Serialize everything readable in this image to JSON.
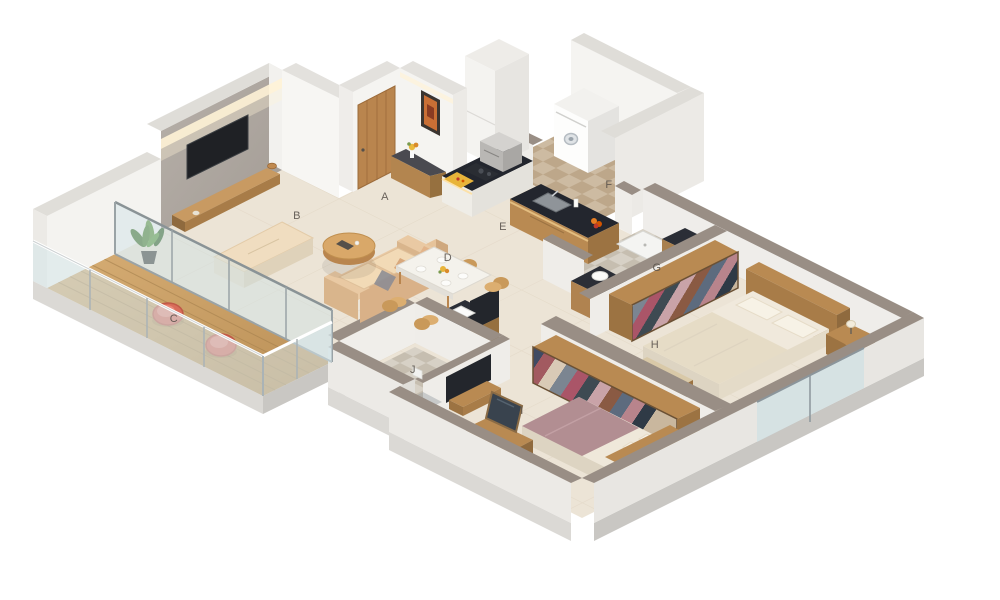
{
  "scene": {
    "kind": "isometric-3d-floor-plan-render",
    "background": "#ffffff"
  },
  "labels": [
    {
      "label": "A",
      "area": "entrance-foyer"
    },
    {
      "label": "B",
      "area": "living-room"
    },
    {
      "label": "C",
      "area": "balcony-deck"
    },
    {
      "label": "D",
      "area": "dining-area"
    },
    {
      "label": "E",
      "area": "kitchen"
    },
    {
      "label": "F",
      "area": "utility-area"
    },
    {
      "label": "G",
      "area": "bathroom"
    },
    {
      "label": "H",
      "area": "master-bedroom"
    },
    {
      "label": "I",
      "area": "bedroom-2"
    },
    {
      "label": "J",
      "area": "toilet"
    }
  ],
  "palette": {
    "wall_white": "#f5f4f1",
    "wall_cap": "#dfddd8",
    "parapet_cap": "#998e85",
    "floor_cream": "#ece4d6",
    "deck_wood": "#c9a068",
    "counter_dark": "#23262e",
    "furniture_wood": "#b98a52",
    "tv_feature_wall": "#b0a9a2",
    "sofa_tan": "#e9c9a3",
    "balcony_chair_coral": "#d96c5a",
    "bedding_cream": "#efe8da",
    "bedding_mauve": "#b28e92",
    "glass": "#cfe4e8",
    "cove_light": "#fff3d6"
  }
}
